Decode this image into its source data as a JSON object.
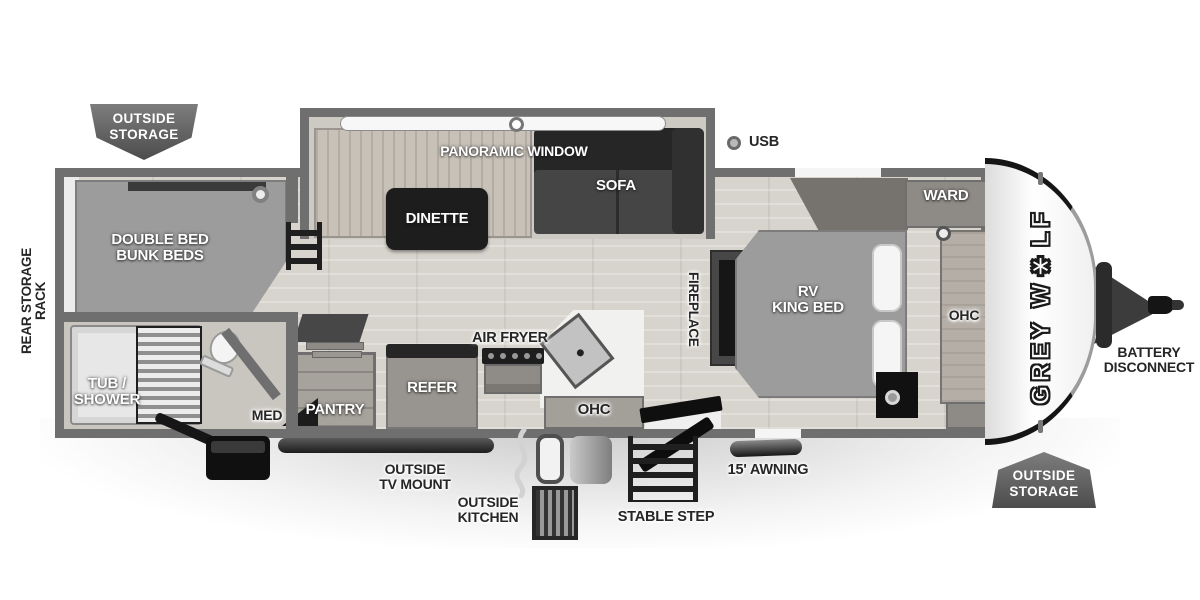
{
  "badges": {
    "top_left": {
      "text": "OUTSIDE\nSTORAGE"
    },
    "bottom_right": {
      "text": "OUTSIDE\nSTORAGE"
    }
  },
  "exterior": {
    "rear_storage_rack": "REAR STORAGE RACK",
    "usb": "USB",
    "outside_tv_mount": "OUTSIDE\nTV MOUNT",
    "outside_kitchen": "OUTSIDE\nKITCHEN",
    "stable_step": "STABLE STEP",
    "awning": "15' AWNING",
    "battery_disconnect": "BATTERY\nDISCONNECT",
    "brand": "GREY WOLF",
    "brand_display": "GREY W✱LF"
  },
  "interior": {
    "bunk_beds": "DOUBLE BED\nBUNK BEDS",
    "tub_shower": "TUB /\nSHOWER",
    "med": "MED",
    "pantry": "PANTRY",
    "refer": "REFER",
    "air_fryer": "AIR FRYER",
    "ohc_kitchen": "OHC",
    "dinette": "DINETTE",
    "sofa": "SOFA",
    "panoramic_window": "PANORAMIC WINDOW",
    "fireplace": "FIREPLACE",
    "rv_king_bed": "RV\nKING BED",
    "ward": "WARD",
    "ohc_bedroom": "OHC"
  },
  "colors": {
    "wall": "#6f6f6f",
    "floor": "#d7d3cd",
    "furniture_dark": "#1d1d1d",
    "bed_gray": "#9c9c9c",
    "badge_gray": "#5a5a5a",
    "label_light": "#ffffff",
    "label_dark": "#262626"
  }
}
